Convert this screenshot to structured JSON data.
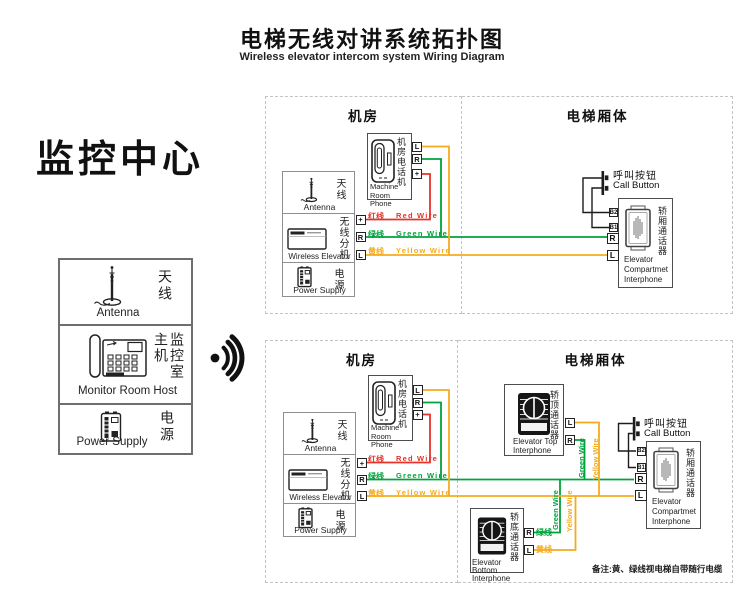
{
  "title": {
    "zh": "电梯无线对讲系统拓扑图",
    "en": "Wireless elevator intercom system Wiring Diagram"
  },
  "monitor": {
    "heading": "监控中心",
    "antenna_zh": "天线",
    "antenna_en": "Antenna",
    "host_zh": "监控室主机",
    "host_en": "Monitor Room Host",
    "power_zh": "电源",
    "power_en": "Power Supply"
  },
  "zones": {
    "machine_room": "机房",
    "elevator_body": "电梯厢体"
  },
  "devices": {
    "antenna_zh": "天线",
    "antenna_en": "Antenna",
    "wireless_zh": "无线分机",
    "wireless_en": "Wireless Elevator",
    "power_zh": "电源",
    "power_en": "Power Supply",
    "phone_zh": "机房电话机",
    "phone_en1": "Machine",
    "phone_en2": "Room Phone",
    "callbtn_zh": "呼叫按钮",
    "callbtn_en": "Call Button",
    "compartment_zh": "轿厢通话器",
    "compartment_en1": "Elevator",
    "compartment_en2": "Compartmet",
    "compartment_en3": "Interphone",
    "top_zh": "轿顶通话器",
    "top_en1": "Elevator Top",
    "top_en2": "Interphone",
    "bottom_zh": "轿底通话器",
    "bottom_en1": "Elevator Bottom",
    "bottom_en2": "Interphone"
  },
  "terminals": {
    "l": "L",
    "r": "R",
    "plus": "+",
    "b1": "B1",
    "b2": "B2"
  },
  "wires": {
    "red_zh": "红线",
    "red_en": "Red Wire",
    "red_color": "#e5332a",
    "green_zh": "绿线",
    "green_en": "Green Wire",
    "green_color": "#00a23c",
    "yellow_zh": "黄线",
    "yellow_en": "Yellow Wire",
    "yellow_color": "#f5ab1d"
  },
  "note": "备注:黄、绿线视电梯自带随行电缆"
}
